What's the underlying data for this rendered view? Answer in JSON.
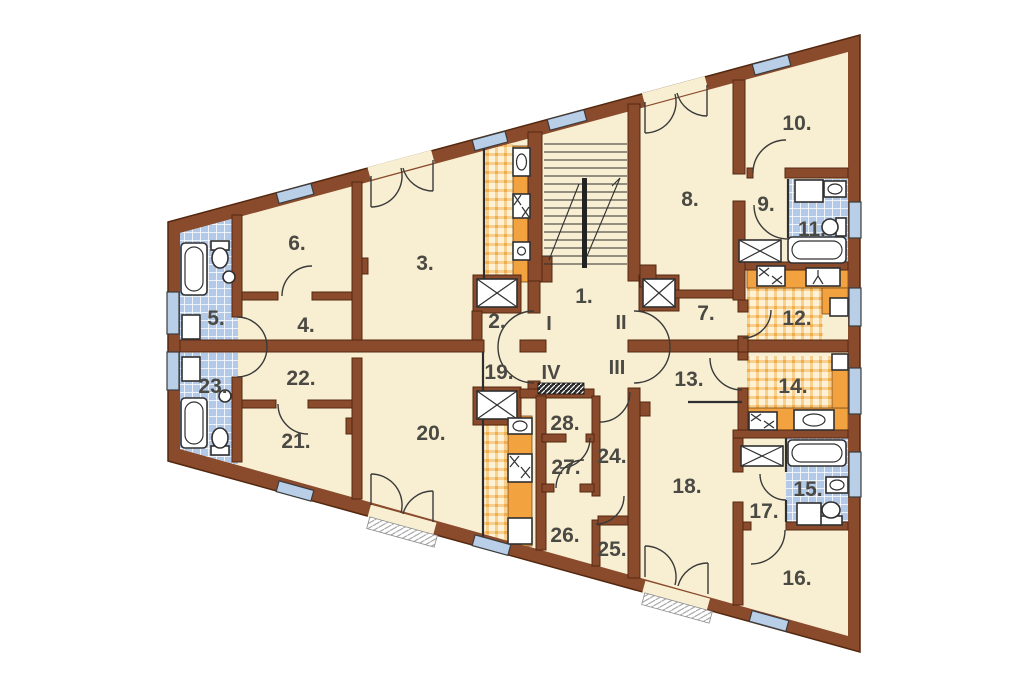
{
  "type": "architectural-floor-plan",
  "colors": {
    "wall": "#8a4a2c",
    "wall_outline": "#53280f",
    "floor": "#f8efd2",
    "bathroom_tile": "#b9cde9",
    "kitchen_tile_bg": "#fdf1d6",
    "kitchen_tile_line": "#f2ae4e",
    "counter": "#f2a23f",
    "window": "#b9cfe8",
    "label": "#4a4943",
    "background": "#ffffff"
  },
  "rooms": {
    "n1": "1.",
    "n2": "2.",
    "n3": "3.",
    "n4": "4.",
    "n5": "5.",
    "n6": "6.",
    "n7": "7.",
    "n8": "8.",
    "n9": "9.",
    "n10": "10.",
    "n11": "11.",
    "n12": "12.",
    "n13": "13.",
    "n14": "14.",
    "n15": "15.",
    "n16": "16.",
    "n17": "17.",
    "n18": "18.",
    "n19": "19.",
    "n20": "20.",
    "n21": "21.",
    "n22": "22.",
    "n23": "23.",
    "n24": "24.",
    "n25": "25.",
    "n26": "26.",
    "n27": "27.",
    "n28": "28."
  },
  "halls": {
    "rI": "I",
    "rII": "II",
    "rIII": "III",
    "rIV": "IV"
  },
  "icons": [
    "bathtub-icon",
    "toilet-icon",
    "sink-icon",
    "stove-icon",
    "washer-icon",
    "refrigerator-icon",
    "elevator-shaft-icon",
    "duct-icon",
    "staircase-icon",
    "wardrobe-icon",
    "window-icon",
    "door-arc-icon",
    "balcony-sill-icon"
  ]
}
